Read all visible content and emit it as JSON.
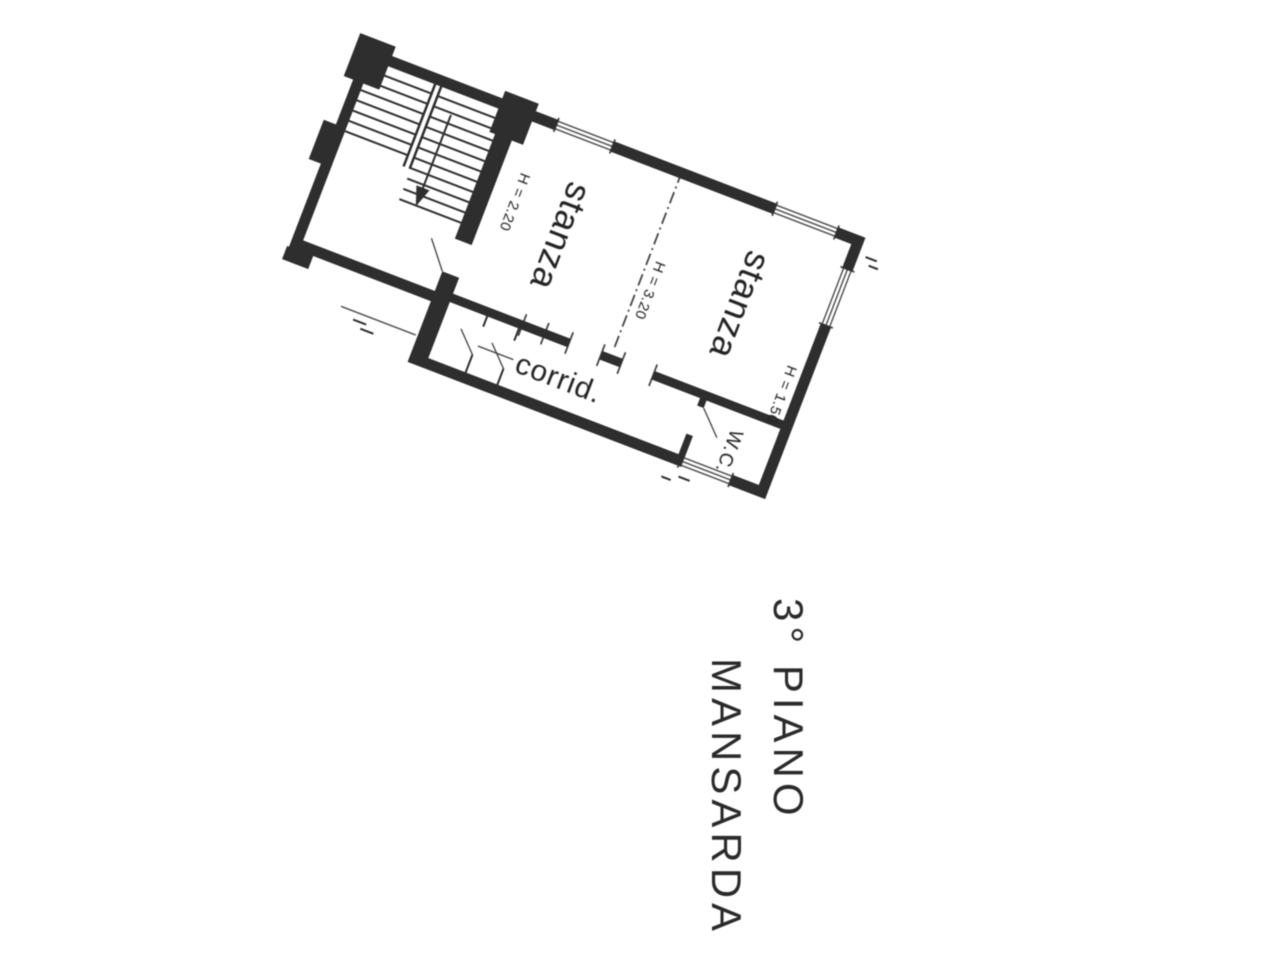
{
  "page": {
    "background_color": "#ffffff",
    "ink_color": "#2d2d2d"
  },
  "floor_plan": {
    "rotation_deg": 21,
    "room_labels": {
      "stanza_top": "stanza",
      "stanza_right": "stanza",
      "corridor": "corrid.",
      "wc": "W.C."
    },
    "height_annotations": {
      "left_eave": "H = 2.20",
      "ridge": "H = 3.20",
      "right_eave": "H = 1.50"
    }
  },
  "caption": {
    "line1": "3° PIANO",
    "line2": "MANSARDA"
  }
}
